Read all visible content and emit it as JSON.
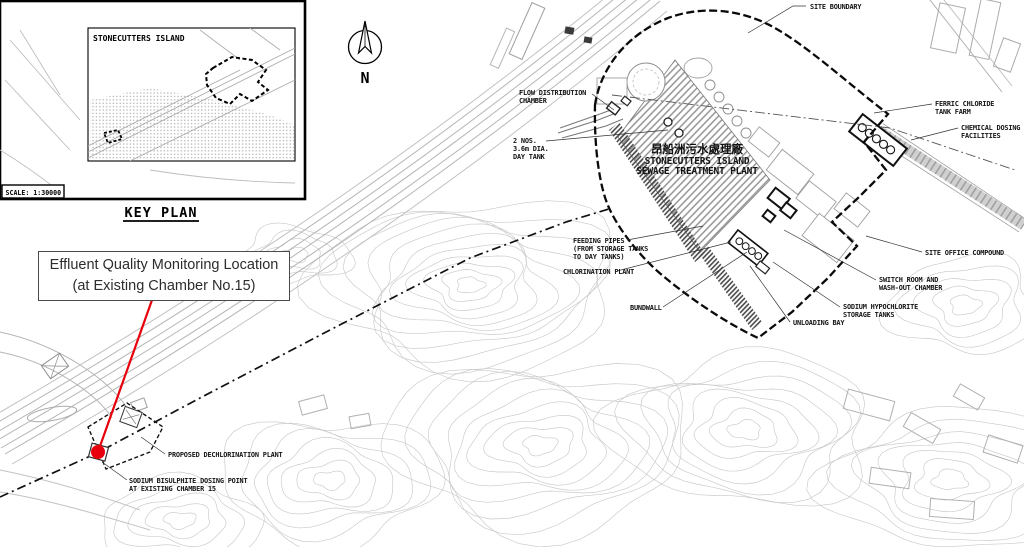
{
  "key_plan": {
    "island_label": "STONECUTTERS ISLAND",
    "scale_label": "SCALE: 1:30000",
    "heading": "KEY PLAN"
  },
  "north": {
    "label": "N"
  },
  "callout": {
    "line1": "Effluent Quality Monitoring Location",
    "line2": "(at Existing Chamber No.15)",
    "accent": "#e8000d"
  },
  "plant_title": {
    "chinese": "昂船洲污水處理廠",
    "line1": "STONECUTTERS ISLAND",
    "line2": "SEWAGE TREATMENT PLANT"
  },
  "map_labels": [
    {
      "id": "site-boundary",
      "lines": [
        "SITE BOUNDARY"
      ],
      "x": 810,
      "y": 9,
      "leader": [
        [
          806,
          6
        ],
        [
          793,
          6
        ],
        [
          748,
          33
        ]
      ]
    },
    {
      "id": "flow-distribution-chamber",
      "lines": [
        "FLOW DISTRIBUTION",
        "CHAMBER"
      ],
      "x": 519,
      "y": 95,
      "leader": [
        [
          592,
          94
        ],
        [
          614,
          110
        ]
      ]
    },
    {
      "id": "day-tank",
      "lines": [
        "2 NOS.",
        "3.6m DIA.",
        "DAY TANK"
      ],
      "x": 513,
      "y": 143,
      "leader": [
        [
          546,
          141
        ],
        [
          668,
          130
        ]
      ]
    },
    {
      "id": "ferric-chloride-tank-farm",
      "lines": [
        "FERRIC CHLORIDE",
        "TANK FARM"
      ],
      "x": 935,
      "y": 106,
      "leader": [
        [
          932,
          104
        ],
        [
          874,
          113
        ]
      ]
    },
    {
      "id": "chemical-dosing-facilities",
      "lines": [
        "CHEMICAL DOSING",
        "FACILITIES"
      ],
      "x": 961,
      "y": 130,
      "leader": [
        [
          958,
          128
        ],
        [
          911,
          140
        ]
      ]
    },
    {
      "id": "site-office-compound",
      "lines": [
        "SITE OFFICE COMPOUND"
      ],
      "x": 925,
      "y": 255,
      "leader": [
        [
          922,
          252
        ],
        [
          866,
          236
        ]
      ]
    },
    {
      "id": "feeding-pipes",
      "lines": [
        "FEEDING PIPES",
        "(FROM STORAGE TANKS",
        "TO DAY TANKS)"
      ],
      "x": 573,
      "y": 243,
      "leader": [
        [
          627,
          240
        ],
        [
          703,
          226
        ]
      ]
    },
    {
      "id": "chlorination-plant",
      "lines": [
        "CHLORINATION PLANT"
      ],
      "x": 563,
      "y": 274,
      "leader": [
        [
          617,
          271
        ],
        [
          731,
          242
        ]
      ]
    },
    {
      "id": "bundwall",
      "lines": [
        "BUNDWALL"
      ],
      "x": 630,
      "y": 310,
      "leader": [
        [
          663,
          307
        ],
        [
          747,
          252
        ]
      ]
    },
    {
      "id": "switch-room",
      "lines": [
        "SWITCH ROOM AND",
        "WASH-OUT CHAMBER"
      ],
      "x": 879,
      "y": 282,
      "leader": [
        [
          876,
          280
        ],
        [
          784,
          230
        ]
      ]
    },
    {
      "id": "sodium-hypochlorite",
      "lines": [
        "SODIUM HYPOCHLORITE",
        "STORAGE TANKS"
      ],
      "x": 843,
      "y": 309,
      "leader": [
        [
          840,
          307
        ],
        [
          773,
          262
        ]
      ]
    },
    {
      "id": "unloading-bay",
      "lines": [
        "UNLOADING BAY"
      ],
      "x": 793,
      "y": 325,
      "leader": [
        [
          790,
          322
        ],
        [
          750,
          266
        ]
      ]
    },
    {
      "id": "proposed-dechlorination-plant",
      "lines": [
        "PROPOSED DECHLORINATION PLANT"
      ],
      "x": 168,
      "y": 457,
      "leader": [
        [
          165,
          454
        ],
        [
          141,
          437
        ]
      ]
    },
    {
      "id": "sodium-bisulphite-dosing-point",
      "lines": [
        "SODIUM BISULPHITE DOSING POINT",
        "AT EXISTING CHAMBER 15"
      ],
      "x": 129,
      "y": 483,
      "leader": [
        [
          127,
          480
        ],
        [
          102,
          462
        ]
      ]
    }
  ]
}
